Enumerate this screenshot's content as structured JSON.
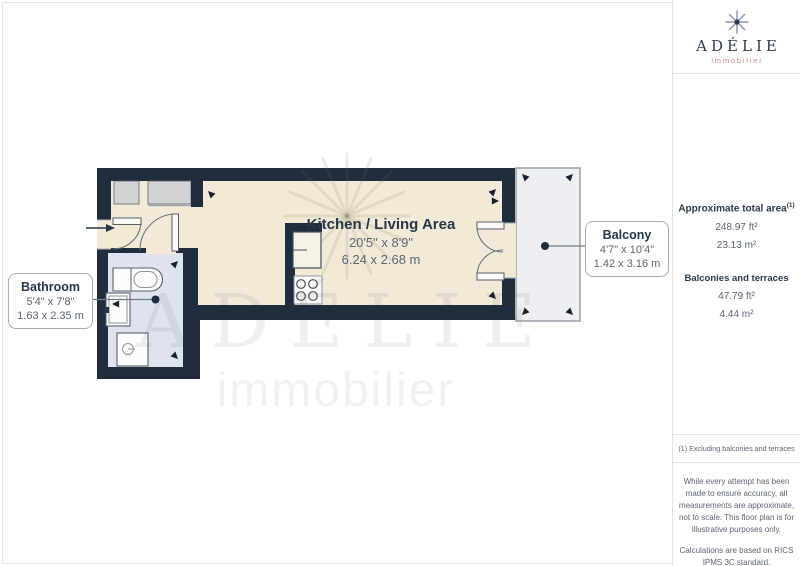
{
  "colors": {
    "wall": "#1f2d3d",
    "living_floor": "#f2ead7",
    "bathroom_floor": "#dfe3f0",
    "balcony_floor": "#edeff2",
    "closet": "#d2d3d5",
    "text_dark": "#273648",
    "text_gray": "#5c6673",
    "brand_navy": "#2d3b50",
    "brand_accent": "#c98b80",
    "divider": "#e4e4e8"
  },
  "logo": {
    "icon": "snowflake-icon",
    "brand": "ADÉLIE",
    "sub": "immobilier"
  },
  "floorplan": {
    "rooms": [
      {
        "id": "kitchen_living",
        "name": "Kitchen / Living Area",
        "dims_ft": "20'5\" x 8'9\"",
        "dims_m": "6.24 x 2.68 m"
      },
      {
        "id": "bathroom",
        "name": "Bathroom",
        "dims_ft": "5'4\" x 7'8\"",
        "dims_m": "1.63 x 2.35 m"
      },
      {
        "id": "balcony",
        "name": "Balcony",
        "dims_ft": "4'7\" x 10'4\"",
        "dims_m": "1.42 x 3.16 m"
      }
    ],
    "watermark": {
      "brand": "ADÉLIE",
      "sub": "immobilier"
    }
  },
  "sidebar": {
    "total_area": {
      "label": "Approximate total area",
      "note_ref": "(1)",
      "ft": "248.97 ft²",
      "m": "23.13 m²"
    },
    "balconies": {
      "label": "Balconies and terraces",
      "ft": "47.79 ft²",
      "m": "4.44 m²"
    },
    "footnote": "(1) Excluding balconies and terraces",
    "disclaimer1": "While every attempt has been made to ensure accuracy, all measurements are approximate, not to scale. This floor plan is for illustrative purposes only.",
    "disclaimer2": "Calculations are based on RICS IPMS 3C standard.",
    "credit": {
      "name": "GIRAFFE",
      "suffix": "360"
    }
  }
}
